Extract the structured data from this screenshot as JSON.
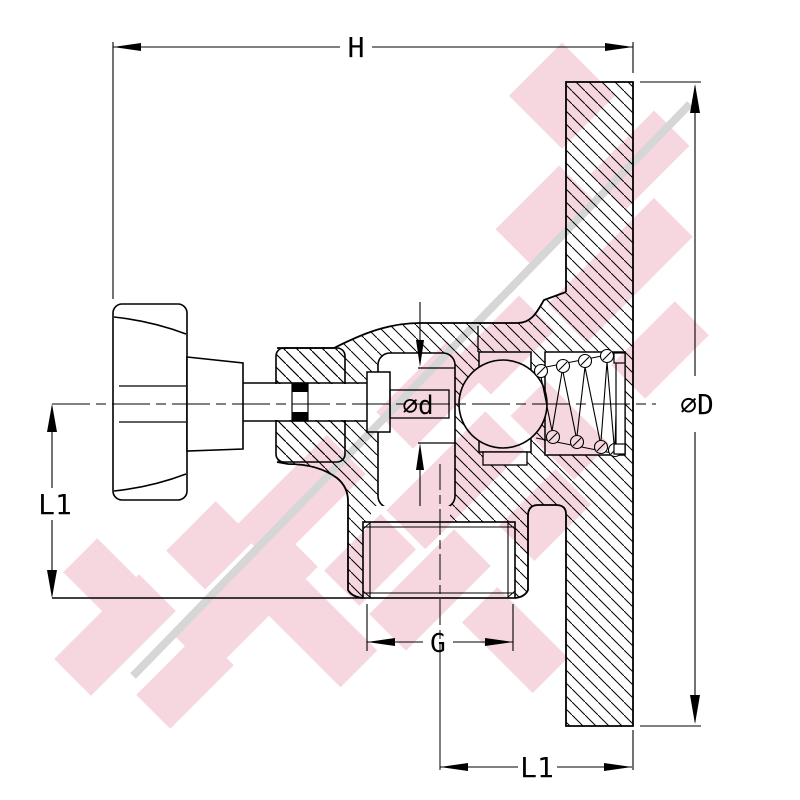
{
  "drawing": {
    "labels": {
      "overall_width": "H",
      "plate_diameter": "∅D",
      "left_length": "L1",
      "orifice_diameter": "∅d",
      "thread_size": "G",
      "bottom_length": "L1"
    },
    "colors": {
      "line": "#000000",
      "background": "#ffffff",
      "watermark_pink": "#f6d7df",
      "watermark_gray": "#d6d6d6"
    }
  }
}
